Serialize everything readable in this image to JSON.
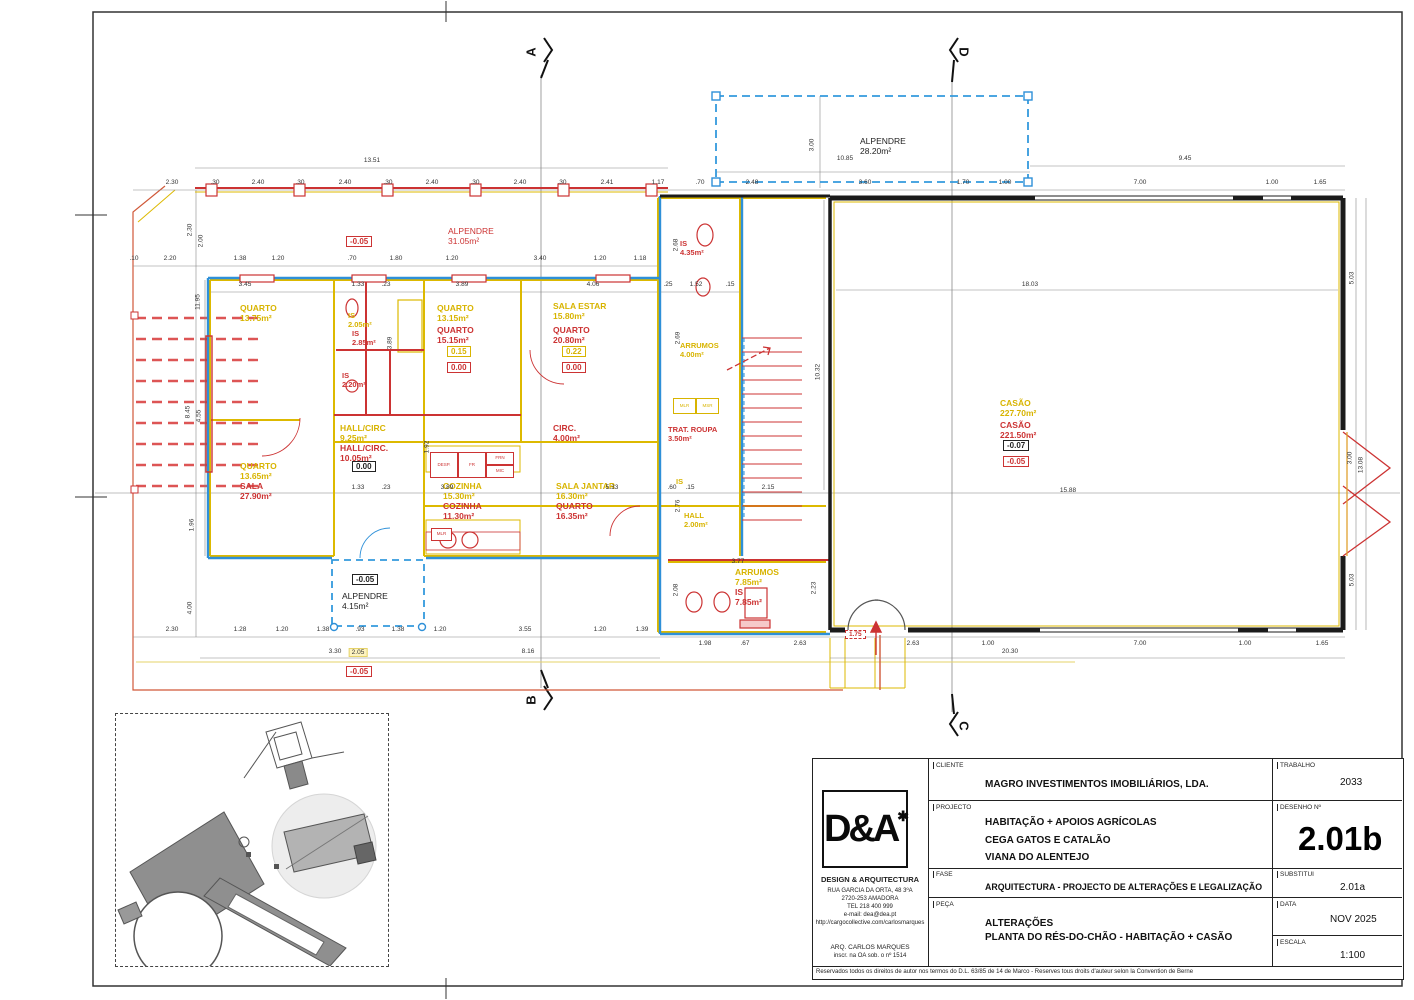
{
  "markers": {
    "a": "A",
    "b": "B",
    "c": "C",
    "d": "D"
  },
  "rooms": {
    "quarto1": {
      "name": "QUARTO",
      "area": "13.75m²"
    },
    "is1_old": {
      "name": "IS",
      "area": "2.05m²"
    },
    "is1_new": {
      "name": "IS",
      "area": "2.85m²"
    },
    "is2_new": {
      "name": "IS",
      "area": "2.20m²"
    },
    "quarto2_old": {
      "name": "QUARTO",
      "area": "13.15m²"
    },
    "quarto2_new": {
      "name": "QUARTO",
      "area": "15.15m²"
    },
    "sala_estar_old": {
      "name": "SALA ESTAR",
      "area": "15.80m²"
    },
    "quarto3_new": {
      "name": "QUARTO",
      "area": "20.80m²"
    },
    "is_top_new": {
      "name": "IS",
      "area": "4.35m²"
    },
    "arrumos_old": {
      "name": "ARRUMOS",
      "area": "4.00m²"
    },
    "circ_new": {
      "name": "CIRC.",
      "area": "4.00m²"
    },
    "trat_roupa_new": {
      "name": "TRAT. ROUPA",
      "area": "3.50m²"
    },
    "hall_circ_old": {
      "name": "HALL/CIRC",
      "area": "9.25m²"
    },
    "hall_circ_new": {
      "name": "HALL/CIRC.",
      "area": "10.05m²"
    },
    "quarto4_old": {
      "name": "QUARTO",
      "area": "13.65m²"
    },
    "sala_new": {
      "name": "SALA",
      "area": "27.90m²"
    },
    "cozinha_old": {
      "name": "COZINHA",
      "area": "15.30m²"
    },
    "cozinha_new": {
      "name": "COZINHA",
      "area": "11.30m²"
    },
    "sala_jantar_old": {
      "name": "SALA JANTAR",
      "area": "16.30m²"
    },
    "quarto5_new": {
      "name": "QUARTO",
      "area": "16.35m²"
    },
    "is_small_old": {
      "name": "IS",
      "area": ""
    },
    "hall_old": {
      "name": "HALL",
      "area": "2.00m²"
    },
    "arrumos2_old": {
      "name": "ARRUMOS",
      "area": "7.85m²"
    },
    "is3_new": {
      "name": "IS",
      "area": "7.85m²"
    },
    "casao_old": {
      "name": "CASÃO",
      "area": "227.70m²"
    },
    "casao_new": {
      "name": "CASÃO",
      "area": "221.50m²"
    },
    "alpendre_top": {
      "name": "ALPENDRE",
      "area": "28.20m²"
    },
    "alpendre_main": {
      "name": "ALPENDRE",
      "area": "31.05m²"
    },
    "alpendre_small": {
      "name": "ALPENDRE",
      "area": "4.15m²"
    }
  },
  "levels": {
    "p015": "0.15",
    "p022": "0.22",
    "p000a": "0.00",
    "p000b": "0.00",
    "p000c": "0.00",
    "m007": "-0.07",
    "m005a": "-0.05",
    "m005b": "-0.05",
    "m005c": "-0.05",
    "m005d": "-0.05",
    "d175": "1.75"
  },
  "fixtures": {
    "mlr": "MLR",
    "msr": "MSR",
    "desp": "DESP.",
    "fr": "FR",
    "frn": "FRN",
    "mic": "MIC",
    "mlr2": "MLR"
  },
  "dims": {
    "overall": [
      "13.51",
      "10.85",
      "9.45",
      "18.03",
      "15.88"
    ],
    "top": [
      "2.30",
      ".30",
      "2.40",
      ".30",
      "2.40",
      ".30",
      "2.40",
      ".30",
      "2.40",
      ".30",
      "2.41",
      "1.17",
      ".70",
      "2.48",
      "3.60",
      "1.70",
      "1.00",
      "7.00",
      "1.00",
      "1.65"
    ],
    "row2": [
      ".10",
      "2.20",
      "1.38",
      "1.20",
      ".70",
      "1.80",
      "1.20",
      "3.40",
      "1.20",
      "1.18"
    ],
    "row3": [
      "3.45",
      "1.33",
      ".23",
      "3.89",
      "4.06",
      ".25",
      "1.52",
      ".15"
    ],
    "mid": [
      "1.33",
      ".23",
      "3.89",
      "5.33",
      ".60",
      ".15",
      "2.15"
    ],
    "bottom": [
      "2.30",
      "1.28",
      "1.20",
      "1.38",
      ".93",
      "1.38",
      "1.20",
      "3.55",
      "1.20",
      "1.39",
      "1.98",
      ".67",
      "2.63",
      "2.63",
      "1.00",
      "7.00",
      "1.00",
      "1.65"
    ],
    "bottom2": [
      "3.30",
      "2.05",
      "8.16",
      "20.30"
    ],
    "left": [
      "2.30",
      "2.00",
      "11.95",
      "8.45",
      "4.55",
      "1.96",
      "4.00"
    ],
    "right": [
      "5.03",
      "3.00",
      "13.08",
      "5.03"
    ],
    "innerv": [
      "3.89",
      "1.92",
      "2.68",
      "2.69",
      "2.76",
      "2.08",
      "2.23",
      "10.32",
      "3.00"
    ],
    "innerh": [
      "3.77"
    ]
  },
  "title_block": {
    "logo_mark": "D&A",
    "logo_star": "✱",
    "logo_sub": "DESIGN  &  ARQUITECTURA",
    "address": [
      "RUA GARCIA DA ORTA, 48 3ºA",
      "2720-253 AMADORA",
      "TEL 218 400 999",
      "e-mail: dea@dea.pt",
      "http://cargocollective.com/carlosmarques"
    ],
    "architect": [
      "ARQ. CARLOS MARQUES",
      "inscr. na OA sob. o nº 1514"
    ],
    "fields": {
      "cliente_label": "CLIENTE",
      "cliente": "MAGRO INVESTIMENTOS IMOBILIÁRIOS, LDA.",
      "projecto_label": "PROJECTO",
      "projecto_lines": [
        "HABITAÇÃO + APOIOS AGRÍCOLAS",
        "CEGA GATOS E CATALÃO",
        "VIANA DO ALENTEJO"
      ],
      "fase_label": "FASE",
      "fase": "ARQUITECTURA - PROJECTO DE ALTERAÇÕES E LEGALIZAÇÃO",
      "peca_label": "PEÇA",
      "peca_lines": [
        "ALTERAÇÕES",
        "PLANTA DO RÉS-DO-CHÃO - HABITAÇÃO + CASÃO"
      ],
      "trabalho_label": "TRABALHO",
      "trabalho": "2033",
      "desenho_label": "DESENHO Nº",
      "desenho": "2.01b",
      "substitui_label": "SUBSTITUI",
      "substitui": "2.01a",
      "data_label": "DATA",
      "data": "NOV 2025",
      "escala_label": "ESCALA",
      "escala": "1:100"
    },
    "copyright": "Reservados todos os direitos de autor nos termos do D.L. 63/85 de 14 de Marco - Reserves tous droits d'auteur selon la Convention de Berne"
  }
}
